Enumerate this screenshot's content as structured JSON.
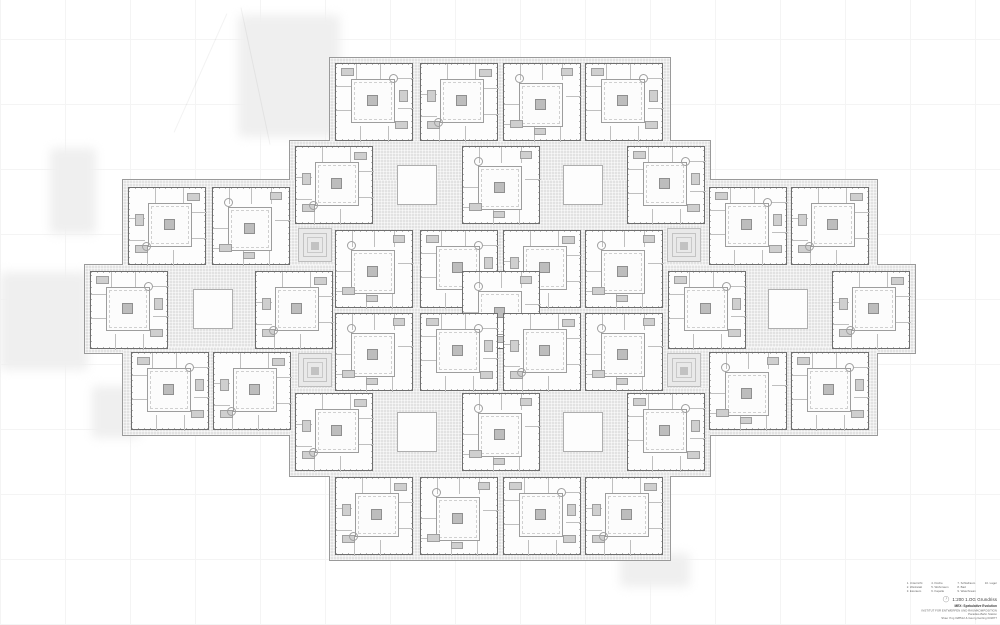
{
  "sheet": {
    "width": 1000,
    "height": 625,
    "background": "#ffffff",
    "grid_color": "#f4f4f4"
  },
  "plan": {
    "module_size": 78,
    "colors": {
      "circulation_fill": "#e2e2e2",
      "silhouette_outline": "#9a9a9a",
      "module_border": "#6e6e6e",
      "courtyard_border": "#9d9d9d",
      "core_fill": "#bdbdbd",
      "furniture_fill": "#cfcfcf"
    },
    "circulation_strips": [
      {
        "x": 330,
        "y": 58,
        "w": 340,
        "h": 88
      },
      {
        "x": 290,
        "y": 141,
        "w": 420,
        "h": 88
      },
      {
        "x": 123,
        "y": 180,
        "w": 754,
        "h": 88
      },
      {
        "x": 330,
        "y": 225,
        "w": 340,
        "h": 88
      },
      {
        "x": 85,
        "y": 265,
        "w": 830,
        "h": 88
      },
      {
        "x": 330,
        "y": 308,
        "w": 340,
        "h": 88
      },
      {
        "x": 123,
        "y": 347,
        "w": 754,
        "h": 88
      },
      {
        "x": 290,
        "y": 388,
        "w": 420,
        "h": 88
      },
      {
        "x": 330,
        "y": 472,
        "w": 340,
        "h": 88
      }
    ],
    "modules": [
      {
        "x": 335,
        "y": 63
      },
      {
        "x": 420,
        "y": 63
      },
      {
        "x": 503,
        "y": 63
      },
      {
        "x": 585,
        "y": 63
      },
      {
        "x": 295,
        "y": 146
      },
      {
        "x": 462,
        "y": 146
      },
      {
        "x": 627,
        "y": 146
      },
      {
        "x": 128,
        "y": 187
      },
      {
        "x": 212,
        "y": 187
      },
      {
        "x": 709,
        "y": 187
      },
      {
        "x": 791,
        "y": 187
      },
      {
        "x": 335,
        "y": 230
      },
      {
        "x": 420,
        "y": 230
      },
      {
        "x": 503,
        "y": 230
      },
      {
        "x": 585,
        "y": 230
      },
      {
        "x": 90,
        "y": 271
      },
      {
        "x": 255,
        "y": 271
      },
      {
        "x": 462,
        "y": 271
      },
      {
        "x": 668,
        "y": 271
      },
      {
        "x": 832,
        "y": 271
      },
      {
        "x": 335,
        "y": 313
      },
      {
        "x": 420,
        "y": 313
      },
      {
        "x": 503,
        "y": 313
      },
      {
        "x": 585,
        "y": 313
      },
      {
        "x": 131,
        "y": 352
      },
      {
        "x": 213,
        "y": 352
      },
      {
        "x": 709,
        "y": 352
      },
      {
        "x": 791,
        "y": 352
      },
      {
        "x": 295,
        "y": 393
      },
      {
        "x": 462,
        "y": 393
      },
      {
        "x": 627,
        "y": 393
      },
      {
        "x": 335,
        "y": 477
      },
      {
        "x": 420,
        "y": 477
      },
      {
        "x": 503,
        "y": 477
      },
      {
        "x": 585,
        "y": 477
      }
    ],
    "light_wells": [
      {
        "x": 397,
        "y": 165,
        "size": 40
      },
      {
        "x": 563,
        "y": 165,
        "size": 40
      },
      {
        "x": 193,
        "y": 289,
        "size": 40
      },
      {
        "x": 768,
        "y": 289,
        "size": 40
      },
      {
        "x": 397,
        "y": 412,
        "size": 40
      },
      {
        "x": 563,
        "y": 412,
        "size": 40
      }
    ],
    "stair_features": [
      {
        "x": 298,
        "y": 228,
        "size": 34
      },
      {
        "x": 667,
        "y": 228,
        "size": 34
      },
      {
        "x": 298,
        "y": 353,
        "size": 34
      },
      {
        "x": 667,
        "y": 353,
        "size": 34
      }
    ],
    "context_shadows": [
      {
        "x": 238,
        "y": 15,
        "w": 102,
        "h": 122
      },
      {
        "x": 0,
        "y": 272,
        "w": 88,
        "h": 98
      },
      {
        "x": 50,
        "y": 148,
        "w": 46,
        "h": 86
      },
      {
        "x": 92,
        "y": 386,
        "w": 48,
        "h": 52
      },
      {
        "x": 620,
        "y": 553,
        "w": 70,
        "h": 34
      }
    ]
  },
  "titleblock": {
    "scale_label": "1:200 1.OG Grundriss",
    "project_line1": "MEX: Spekulative Evolution",
    "project_line2": "INSTITUT FÜR ENTWERFEN UND RAUMKOMPOSITION",
    "project_line3": "Paradies-Bahn Station",
    "project_line4": "Shao Ying 028512 & Georg Gerling 031877",
    "legend_items": [
      {
        "n": "1.",
        "label": "Unterricht"
      },
      {
        "n": "2.",
        "label": "Werkstatt"
      },
      {
        "n": "3.",
        "label": "Essraum"
      },
      {
        "n": "4.",
        "label": "Küche"
      },
      {
        "n": "5.",
        "label": "Wohnraum"
      },
      {
        "n": "6.",
        "label": "Kapelle"
      },
      {
        "n": "7.",
        "label": "Schlafraum"
      },
      {
        "n": "8.",
        "label": "Bad"
      },
      {
        "n": "9.",
        "label": "Waschraum"
      },
      {
        "n": "10.",
        "label": "Lager"
      }
    ]
  }
}
